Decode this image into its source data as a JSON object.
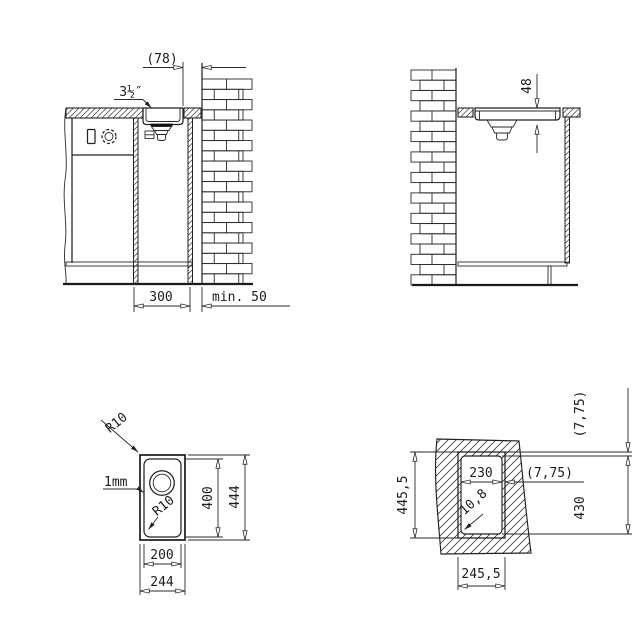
{
  "drawing": {
    "side_view": {
      "offset_to_wall": "(78)",
      "drain_size": "3½″",
      "cabinet_width": "300",
      "wall_clearance": "min. 50"
    },
    "front_view": {
      "bowl_depth": "48"
    },
    "plan_view": {
      "outer_corner_radius": "R10",
      "rim_thickness": "1mm",
      "inner_corner_radius": "R10",
      "bowl_length": "400",
      "overall_length": "444",
      "bowl_width": "200",
      "overall_width": "244"
    },
    "cutout_view": {
      "top_ledge": "(7,75)",
      "cutout_width_inner": "230",
      "side_ledge": "(7,75)",
      "recess_length": "445,5",
      "cutout_length": "430",
      "cutout_corner_radius": "10,8",
      "recess_width": "245,5"
    }
  },
  "colors": {
    "line": "#222222",
    "background": "#ffffff"
  }
}
